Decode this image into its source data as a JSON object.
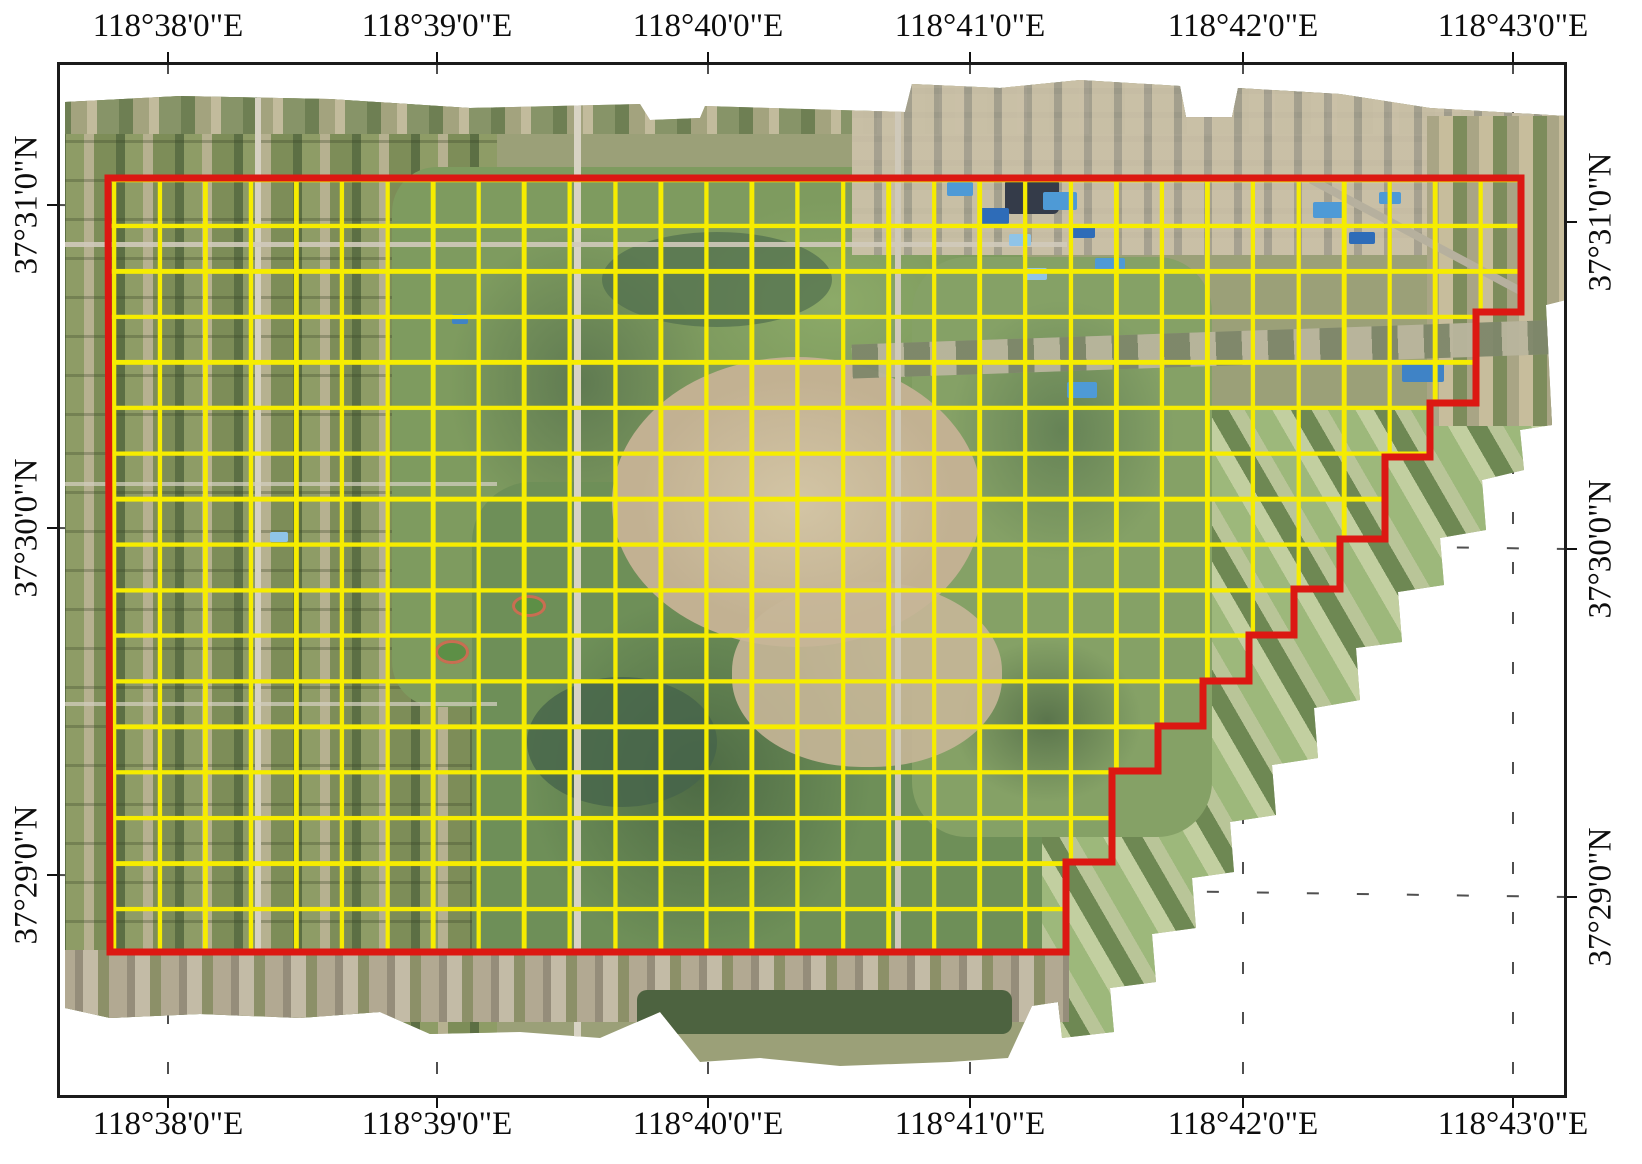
{
  "figure": {
    "description": "UAV orthomosaic map with yellow survey grid and red study area boundary",
    "colors": {
      "survey_grid": "#f6ec00",
      "study_area_boundary": "#dc1812",
      "map_frame": "#1b1b1b",
      "graticule": "#4f4f4f"
    }
  },
  "axis": {
    "top_labels": [
      "118°38'0\"E",
      "118°39'0\"E",
      "118°40'0\"E",
      "118°41'0\"E",
      "118°42'0\"E",
      "118°43'0\"E"
    ],
    "bottom_labels": [
      "118°38'0\"E",
      "118°39'0\"E",
      "118°40'0\"E",
      "118°41'0\"E",
      "118°42'0\"E",
      "118°43'0\"E"
    ],
    "left_labels": [
      "37°31'0\"N",
      "37°30'0\"N",
      "37°29'0\"N"
    ],
    "right_labels": [
      "37°31'0\"N",
      "37°30'0\"N",
      "37°29'0\"N"
    ]
  }
}
